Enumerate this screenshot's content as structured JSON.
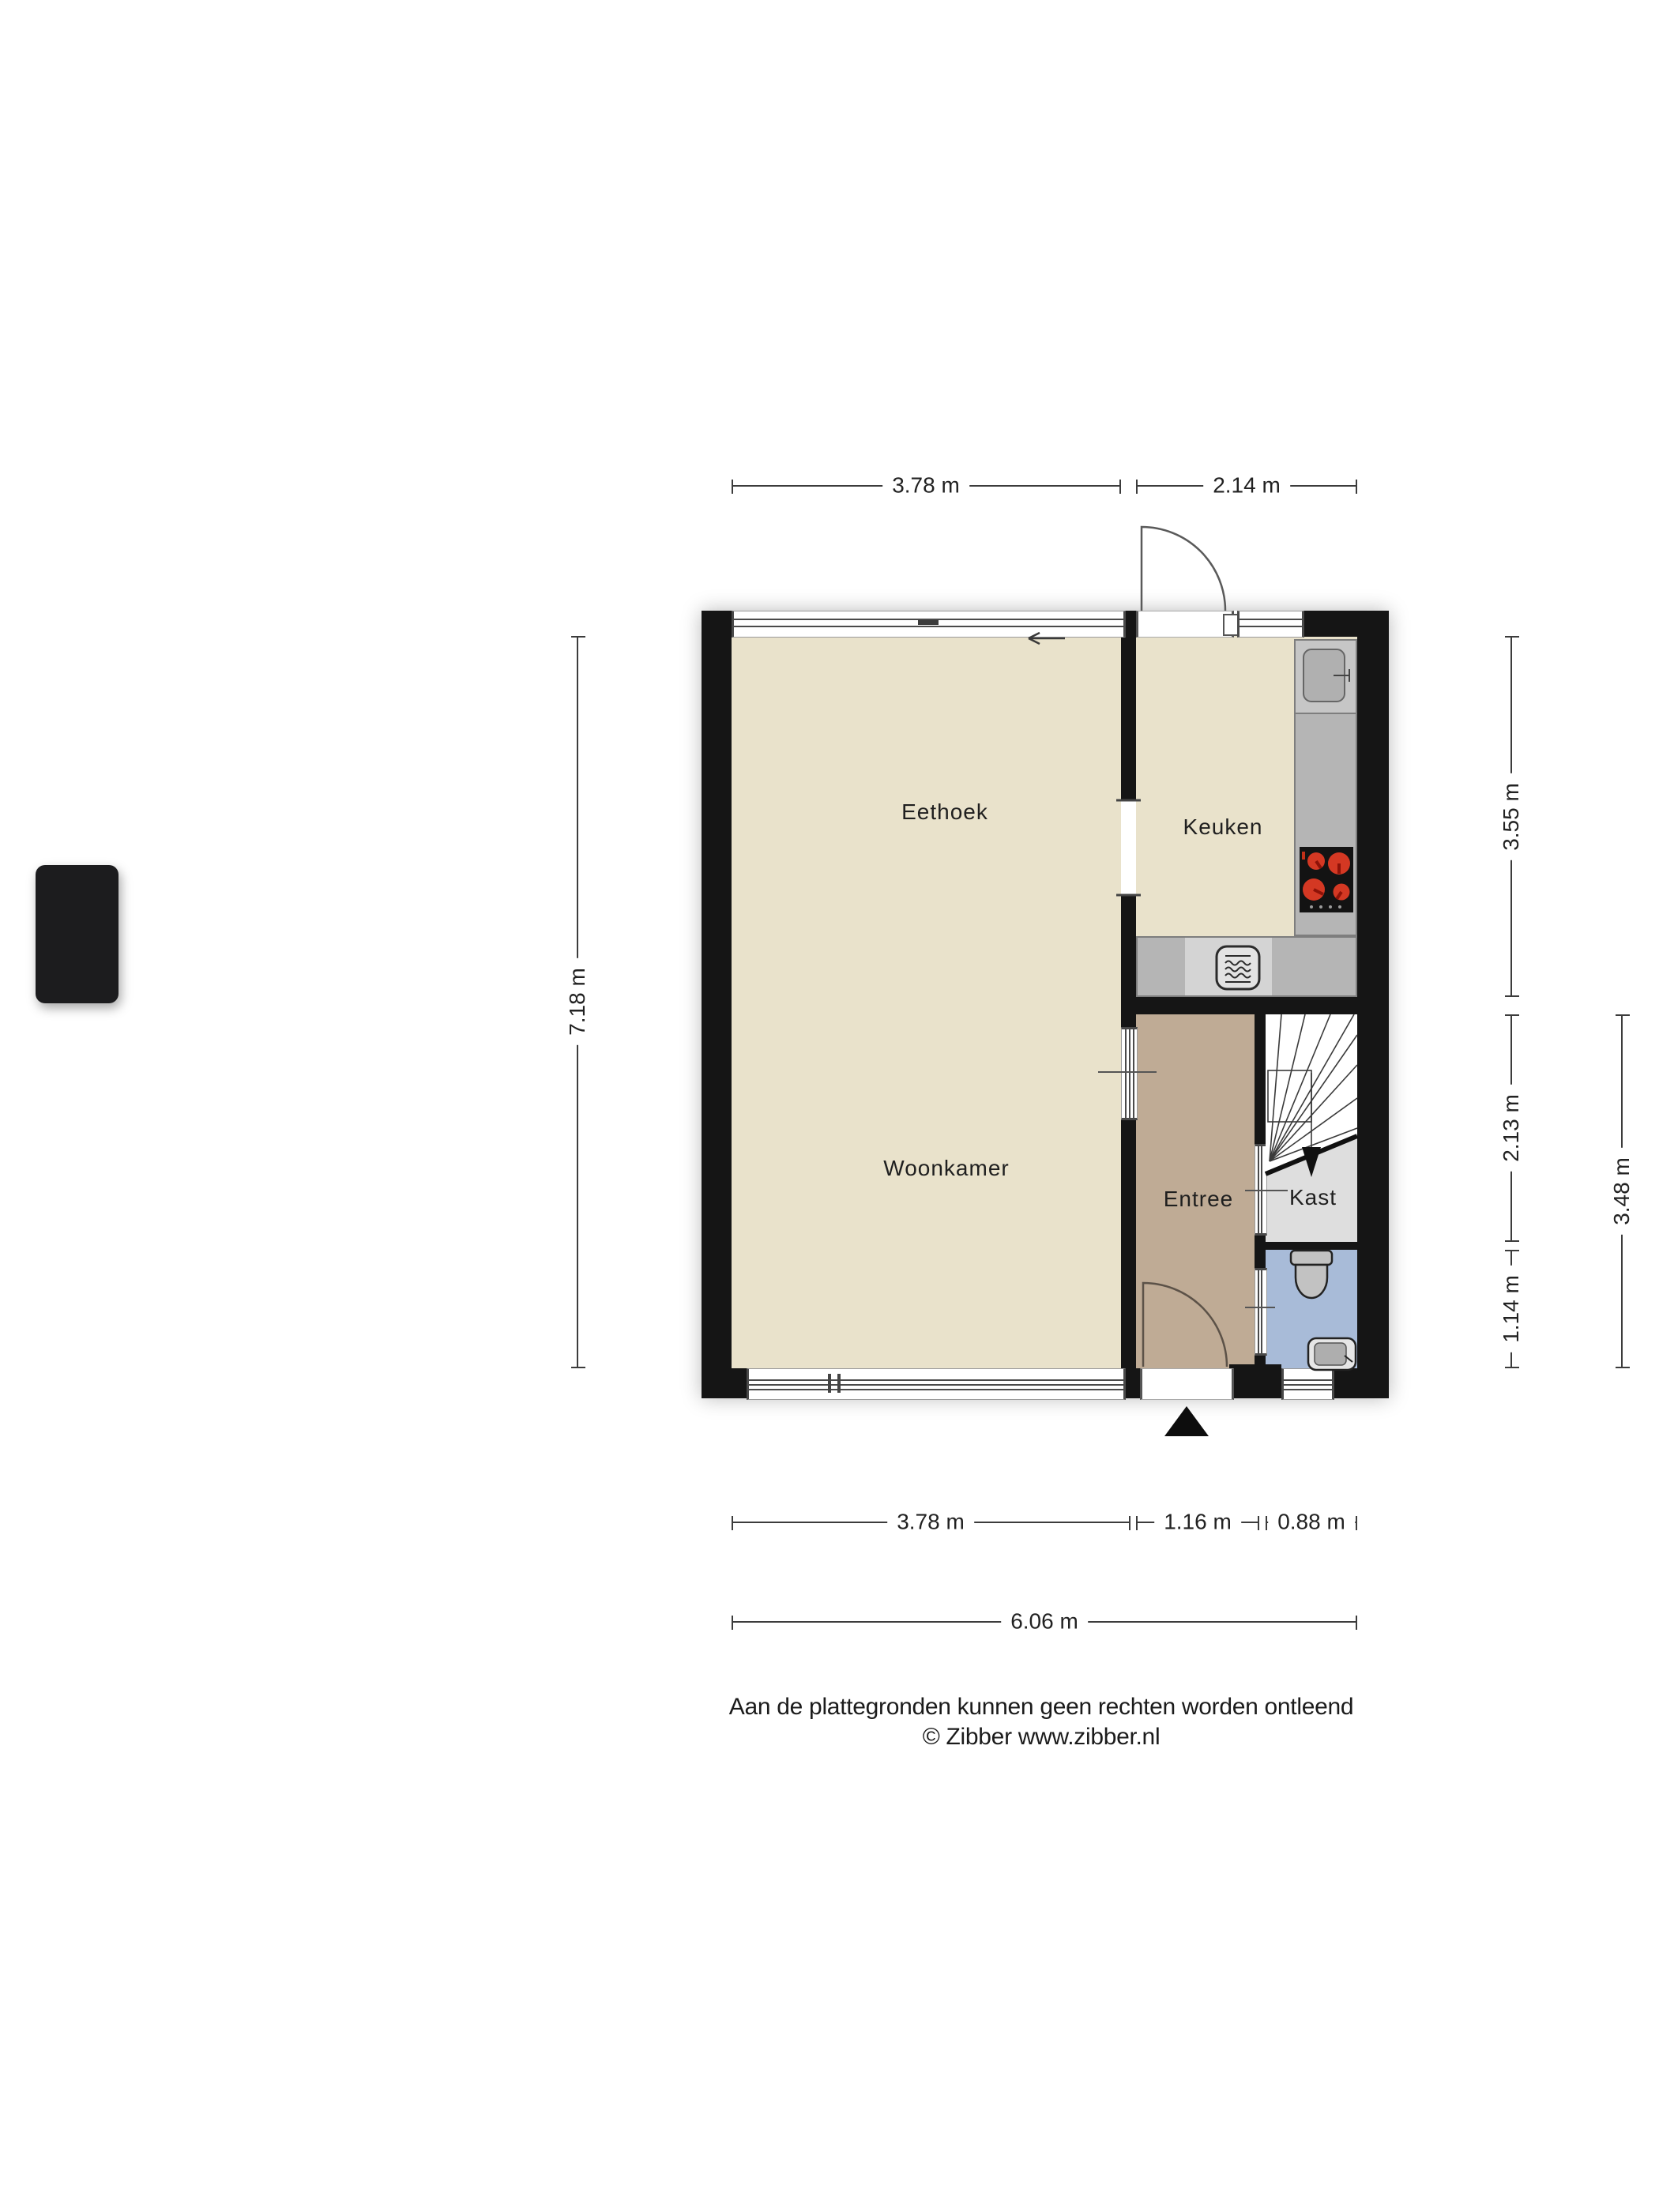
{
  "floorplan": {
    "rooms": {
      "eethoek": "Eethoek",
      "keuken": "Keuken",
      "woonkamer": "Woonkamer",
      "entree": "Entree",
      "kast": "Kast"
    },
    "dimensions": {
      "top": [
        "3.78 m",
        "2.14 m"
      ],
      "left": "7.18 m",
      "right_inner": [
        "3.55 m",
        "2.13 m",
        "1.14 m"
      ],
      "right_outer": "3.48 m",
      "bottom": [
        "3.78 m",
        "1.16 m",
        "0.88 m"
      ],
      "total_width": "6.06 m"
    },
    "icons": [
      "stairs-icon",
      "toilet-icon",
      "wash-basin-icon",
      "kitchen-sink-icon",
      "stove-icon",
      "oven-icon",
      "door-swing-icon",
      "entrance-arrow-icon",
      "direction-arrow-icon"
    ],
    "colors": {
      "wall": "#151515",
      "floor_living": "#e9e2cb",
      "floor_entree": "#bfab95",
      "floor_kast": "#dedede",
      "floor_toilet": "#a8bbd8",
      "counter": "#b5b5b5",
      "counter_light": "#d4d4d4",
      "burner_red": "#d43823"
    }
  },
  "footer": {
    "disclaimer": "Aan de plattegronden kunnen geen rechten worden ontleend",
    "copyright": "© Zibber www.zibber.nl"
  }
}
